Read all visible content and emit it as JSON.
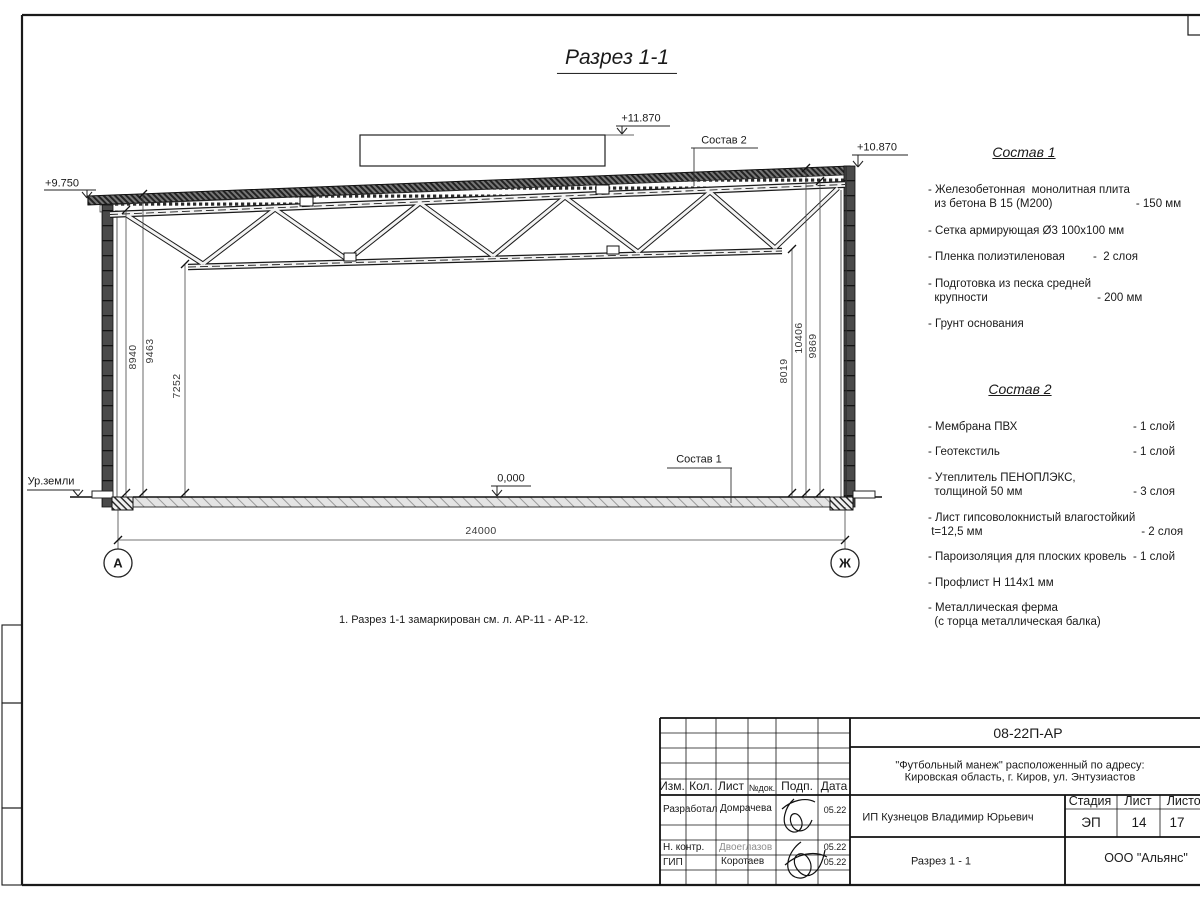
{
  "title": "Разрез 1-1",
  "drawing": {
    "elev_left": "+9.750",
    "elev_parapet": "+11.870",
    "elev_right": "+10.870",
    "elev_floor": "0,000",
    "ground": "Ур.земли",
    "span": "24000",
    "dims_left": [
      "8940",
      "9463",
      "7252"
    ],
    "dims_right": [
      "8019",
      "10406",
      "9869"
    ],
    "axis_a": "А",
    "axis_zh": "Ж",
    "leader1": "Состав 1",
    "leader2": "Состав 2"
  },
  "note": "1. Разрез 1-1 замаркирован см. л. АР-11 - АР-12.",
  "sostav1": {
    "title": "Состав 1",
    "items": [
      {
        "name": "- Железобетонная  монолитная плита\n  из бетона В 15 (М200)",
        "qty": "- 150 мм"
      },
      {
        "name": "- Сетка армирующая Ø3 100х100 мм",
        "qty": ""
      },
      {
        "name": "- Пленка полиэтиленовая",
        "qty": "-  2 слоя"
      },
      {
        "name": "- Подготовка из песка средней\n  крупности",
        "qty": "- 200 мм"
      },
      {
        "name": "- Грунт основания",
        "qty": ""
      }
    ]
  },
  "sostav2": {
    "title": "Состав 2",
    "items": [
      {
        "name": "- Мембрана ПВХ",
        "qty": "- 1 слой"
      },
      {
        "name": "- Геотекстиль",
        "qty": "- 1 слой"
      },
      {
        "name": "- Утеплитель ПЕНОПЛЭКС,\n  толщиной 50 мм",
        "qty": "- 3 слоя"
      },
      {
        "name": "- Лист гипсоволокнистый влагостойкий\n t=12,5 мм",
        "qty": "- 2 слоя"
      },
      {
        "name": "- Пароизоляция для плоских кровель",
        "qty": "- 1 слой"
      },
      {
        "name": "- Профлист Н 114х1 мм",
        "qty": ""
      },
      {
        "name": "- Металлическая ферма\n  (с торца металлическая балка)",
        "qty": ""
      }
    ]
  },
  "titleblock": {
    "doc_number": "08-22П-АР",
    "project_line1": "\"Футбольный манеж\" расположенный по адресу:",
    "project_line2": "Кировская область, г. Киров, ул. Энтузиастов",
    "client": "ИП Кузнецов Владимир Юрьевич",
    "sheet_title": "Разрез 1 - 1",
    "company": "ООО \"Альянс\"",
    "headers": {
      "izm": "Изм.",
      "kol": "Кол.",
      "list": "Лист",
      "ndok": "№док.",
      "podp": "Подп.",
      "data": "Дата",
      "stadia": "Стадия",
      "sheet": "Лист",
      "sheets": "Листов"
    },
    "stadia_value": "ЭП",
    "sheet_value": "14",
    "sheets_value": "17",
    "rows": [
      {
        "role": "Разработал",
        "name": "Домрачева",
        "date": "05.22"
      },
      {
        "role": "Н. контр.",
        "name": "Двоеглазов",
        "date": "05.22"
      },
      {
        "role": "ГИП",
        "name": "Коротаев",
        "date": "05.22"
      }
    ]
  }
}
